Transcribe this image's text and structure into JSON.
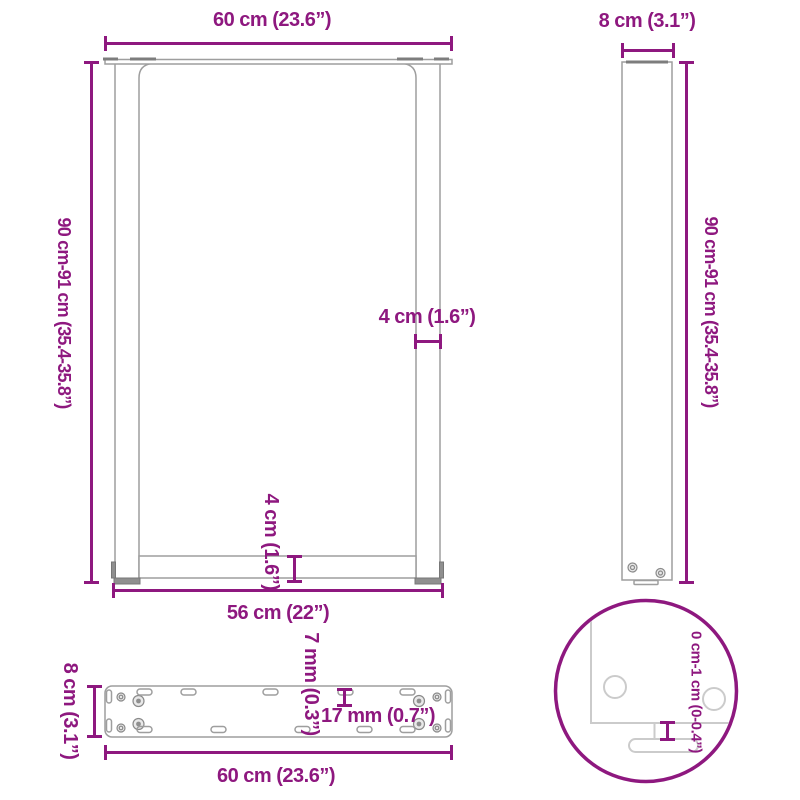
{
  "colors": {
    "accent": "#8E187F",
    "line": "#9E9E9E",
    "line_light": "#CBCBCB",
    "dark": "#7D7D7D",
    "screw": "#8A8A8A"
  },
  "front_view": {
    "top_width": "60 cm (23.6”)",
    "height": "90 cm-91 cm (35.4-35.8”)",
    "bar_width": "4 cm (1.6”)",
    "bar_height": "4 cm (1.6”)",
    "inner_width": "56 cm (22”)"
  },
  "side_view": {
    "depth": "8 cm (3.1”)",
    "height": "90 cm-91 cm (35.4-35.8”)"
  },
  "plate_view": {
    "depth": "8 cm (3.1”)",
    "slot_width": "7 mm (0.3”)",
    "hole_spacing": "17 mm (0.7”)",
    "width": "60 cm (23.6”)"
  },
  "detail_view": {
    "adjustable_height": "0 cm-1 cm (0-0.4”)"
  }
}
